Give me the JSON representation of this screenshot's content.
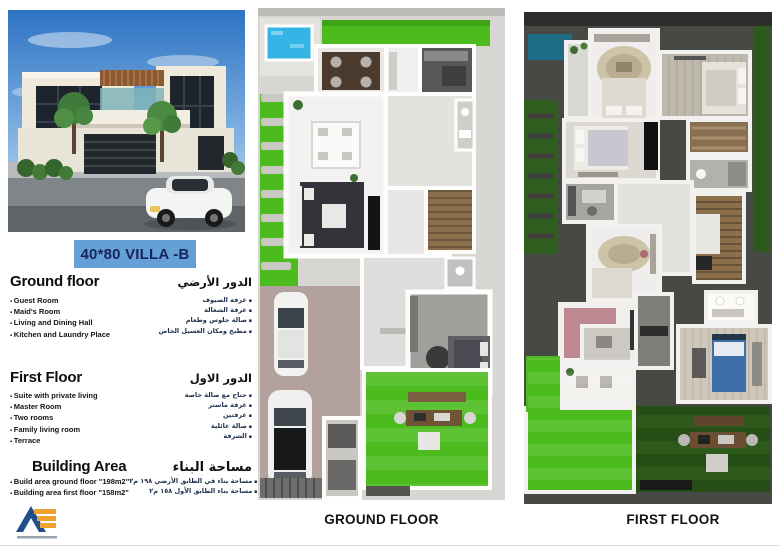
{
  "title": "40*80 VILLA -B",
  "sections": {
    "ground_floor": {
      "heading_en": "Ground floor",
      "heading_ar": "الدور الأرضي",
      "items_en": [
        "Guest Room",
        "Maid's Room",
        "Living and Dining Hall",
        "Kitchen and Laundry Place"
      ],
      "items_ar": [
        "غرفة الضيوف",
        "غرفة الشغالة",
        "صالة جلوس وطعام",
        "مطبخ ومكان الغسيل الخاص"
      ]
    },
    "first_floor": {
      "heading_en": "First Floor",
      "heading_ar": "الدور الاول",
      "items_en": [
        "Suite with private living",
        "Master Room",
        "Two rooms",
        "Family living room",
        "Terrace"
      ],
      "items_ar": [
        "جناح مع صالة خاصة",
        "غرفة ماستر",
        "غرفتين",
        "صالة عائلية",
        "الشرفة"
      ]
    },
    "building_area": {
      "heading_en": "Building Area",
      "heading_ar": "مساحة البناء",
      "items_en": [
        "Build area ground floor \"198m2\"",
        "Building area first floor \"158m2\""
      ],
      "items_ar": [
        "مساحة بناء في الطابق الأرضي ١٩٨ م٢",
        "مساحة بناء الطابق الأول ١٥٨ م٢"
      ]
    }
  },
  "plans": {
    "ground": {
      "label": "GROUND FLOOR"
    },
    "first": {
      "label": "FIRST FLOOR"
    }
  },
  "colors": {
    "title-bg": "#64a0d6",
    "title-text": "#16265c",
    "grass-bright": "#4cbb1e",
    "grass-dark": "#2d5a1b",
    "pool-blue": "#35b5e5",
    "pool-dark": "#1e6b85",
    "driveway": "#b2a19d",
    "stairs-wood": "#8a6f4a",
    "logo-blue": "#1f4e8c",
    "logo-orange": "#f0a22e"
  }
}
